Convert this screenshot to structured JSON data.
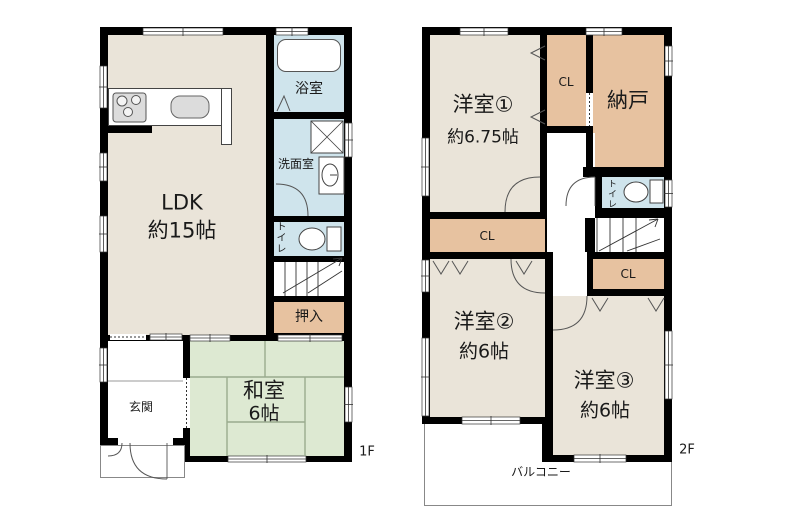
{
  "floorplan": {
    "floor1": {
      "floor_label": "1F",
      "rooms": {
        "ldk_line1": "LDK",
        "ldk_line2": "約15帖",
        "bath": "浴室",
        "washer": "洗",
        "washroom": "洗面室",
        "toilet": "トイレ",
        "closet": "押入",
        "tatami_line1": "和室",
        "tatami_line2": "6帖",
        "entrance": "玄関"
      }
    },
    "floor2": {
      "floor_label": "2F",
      "rooms": {
        "western1_line1": "洋室①",
        "western1_line2": "約6.75帖",
        "closet": "CL",
        "storage": "納戸",
        "toilet": "トイレ",
        "western2_line1": "洋室②",
        "western2_line2": "約6帖",
        "western3_line1": "洋室③",
        "western3_line2": "約6帖",
        "balcony": "バルコニー"
      }
    },
    "colors": {
      "wall": "#000000",
      "room_beige": "#eae4d9",
      "closet_tan": "#e7c2a0",
      "tatami_green": "#dde9d2",
      "water_blue": "#cfe4ec",
      "tatami_line": "#9aab8e"
    }
  }
}
